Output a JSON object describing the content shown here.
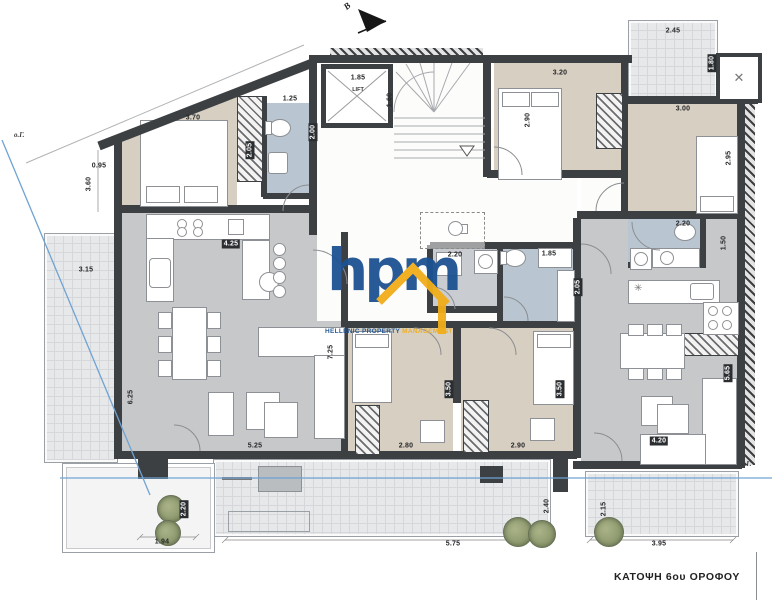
{
  "meta": {
    "drawing_title": "ΚΑΤΟΨΗ 6ου ΟΡΟΦΟΥ",
    "north_label": "B",
    "boundary_label_left": "ο.Γ.",
    "boundary_label_right": "ο.Γ.",
    "lift_label": "LIFT"
  },
  "watermark": {
    "logo_text": "hpm",
    "tagline_primary": "HELLENIC PROPERTY ",
    "tagline_accent": "MANAGEMENT",
    "logo_blue": "#1c5291",
    "logo_yellow": "#f2ae19"
  },
  "palette": {
    "wall": "#3d4043",
    "bedroom_floor": "#d7cfc1",
    "living_floor": "#c7c8ca",
    "bath_floor": "#b9c6d2",
    "balcony_floor": "#e7e8ea",
    "regulation_line_blue": "#6fa3d3",
    "plant_green": "#97a37b"
  },
  "icons": {
    "north_arrow": "black triangle arrow pointing upper-left",
    "fan": "✕",
    "stair_direction": "▽",
    "kitchen_star": "✳"
  },
  "dimensions": [
    {
      "t": "3.70",
      "x": 193,
      "y": 118
    },
    {
      "t": "1.25",
      "x": 290,
      "y": 99
    },
    {
      "t": "2.05",
      "x": 250,
      "y": 150,
      "v": 1,
      "b": 1
    },
    {
      "t": "2.00",
      "x": 313,
      "y": 132,
      "v": 1,
      "b": 1
    },
    {
      "t": "0.95",
      "x": 99,
      "y": 166
    },
    {
      "t": "3.60",
      "x": 89,
      "y": 184,
      "v": 1
    },
    {
      "t": "3.15",
      "x": 86,
      "y": 270
    },
    {
      "t": "6.25",
      "x": 131,
      "y": 397,
      "v": 1
    },
    {
      "t": "4.25",
      "x": 231,
      "y": 244,
      "b": 1
    },
    {
      "t": "7.25",
      "x": 331,
      "y": 352,
      "v": 1
    },
    {
      "t": "5.25",
      "x": 255,
      "y": 446
    },
    {
      "t": "1.85",
      "x": 358,
      "y": 78
    },
    {
      "t": "1.60",
      "x": 390,
      "y": 100,
      "v": 1
    },
    {
      "t": "2.45",
      "x": 673,
      "y": 31
    },
    {
      "t": "1.80",
      "x": 712,
      "y": 63,
      "v": 1,
      "b": 1
    },
    {
      "t": "3.20",
      "x": 560,
      "y": 73
    },
    {
      "t": "2.90",
      "x": 528,
      "y": 120,
      "v": 1
    },
    {
      "t": "3.00",
      "x": 683,
      "y": 109
    },
    {
      "t": "2.95",
      "x": 729,
      "y": 158,
      "v": 1
    },
    {
      "t": "2.20",
      "x": 455,
      "y": 255
    },
    {
      "t": "1.85",
      "x": 549,
      "y": 254
    },
    {
      "t": "2.05",
      "x": 578,
      "y": 287,
      "v": 1,
      "b": 1
    },
    {
      "t": "2.20",
      "x": 683,
      "y": 224
    },
    {
      "t": "1.50",
      "x": 724,
      "y": 243,
      "v": 1
    },
    {
      "t": "2.80",
      "x": 406,
      "y": 446
    },
    {
      "t": "2.90",
      "x": 518,
      "y": 446
    },
    {
      "t": "3.50",
      "x": 449,
      "y": 389,
      "v": 1,
      "b": 1
    },
    {
      "t": "3.50",
      "x": 560,
      "y": 389,
      "v": 1,
      "b": 1
    },
    {
      "t": "4.20",
      "x": 659,
      "y": 441,
      "b": 1
    },
    {
      "t": "5.65",
      "x": 728,
      "y": 373,
      "v": 1,
      "b": 1
    },
    {
      "t": "5.75",
      "x": 453,
      "y": 544
    },
    {
      "t": "2.40",
      "x": 547,
      "y": 506,
      "v": 1
    },
    {
      "t": "3.95",
      "x": 659,
      "y": 544
    },
    {
      "t": "2.15",
      "x": 604,
      "y": 509,
      "v": 1
    },
    {
      "t": "1.94",
      "x": 162,
      "y": 542
    },
    {
      "t": "2.20",
      "x": 184,
      "y": 509,
      "v": 1,
      "b": 1
    }
  ],
  "plants": [
    {
      "x": 170,
      "y": 508,
      "r": 13
    },
    {
      "x": 167,
      "y": 532,
      "r": 12
    },
    {
      "x": 517,
      "y": 531,
      "r": 14
    },
    {
      "x": 541,
      "y": 533,
      "r": 13
    },
    {
      "x": 608,
      "y": 531,
      "r": 14
    }
  ]
}
